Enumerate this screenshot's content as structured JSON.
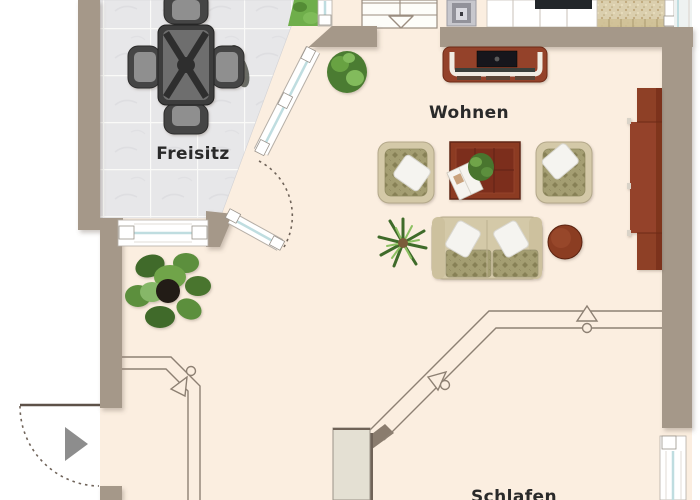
{
  "plan": {
    "kind": "apartment floor plan (attic storey, partial view)",
    "rooms": {
      "freisitz": {
        "label": "Freisitz",
        "floor": "grey tiles",
        "furniture": [
          "patio-dining-table",
          "patio-chair",
          "patio-chair",
          "patio-chair",
          "patio-chair"
        ]
      },
      "wohnen": {
        "label": "Wohnen",
        "floor": "cream",
        "furniture": [
          "tv-sideboard",
          "armchair-left",
          "armchair-right",
          "coffee-table-with-plant-and-magazine",
          "two-seat-sofa",
          "round-side-table",
          "wall-unit",
          "monstera-plant",
          "yucca-plant",
          "bush-plant"
        ]
      },
      "schlafen": {
        "label": "Schlafen",
        "floor": "cream",
        "furniture": [
          "wardrobe"
        ]
      }
    },
    "symbols": {
      "staircase_direction": "triangle arrow pointing down into room",
      "entrance_direction": "solid grey triangle arrow pointing right",
      "door_swing": "dotted quarter-circle arc",
      "roof_slope_marker": "open arrow with small circle on double knee-wall line"
    },
    "colors": {
      "floor_cream": "#fbeee0",
      "wall_taupe": "#a59889",
      "terrace_tile": "#e7e7e9",
      "window_glass": "#bfdde0",
      "window_frame": "#ffffff",
      "wood_red_brown": "#94422a",
      "sofa_beige": "#d4c9a8",
      "cushion_olive": "#a49e72",
      "plant_green": "#5c8f3e",
      "garden_green": "#6fae4b",
      "stone_beige": "#d9cdaa",
      "charcoal_furniture": "#3c3c3c",
      "linework": "#8d8073",
      "entrance_arrow_grey": "#8d8d8d",
      "label_text": "#2a2a2a"
    }
  }
}
